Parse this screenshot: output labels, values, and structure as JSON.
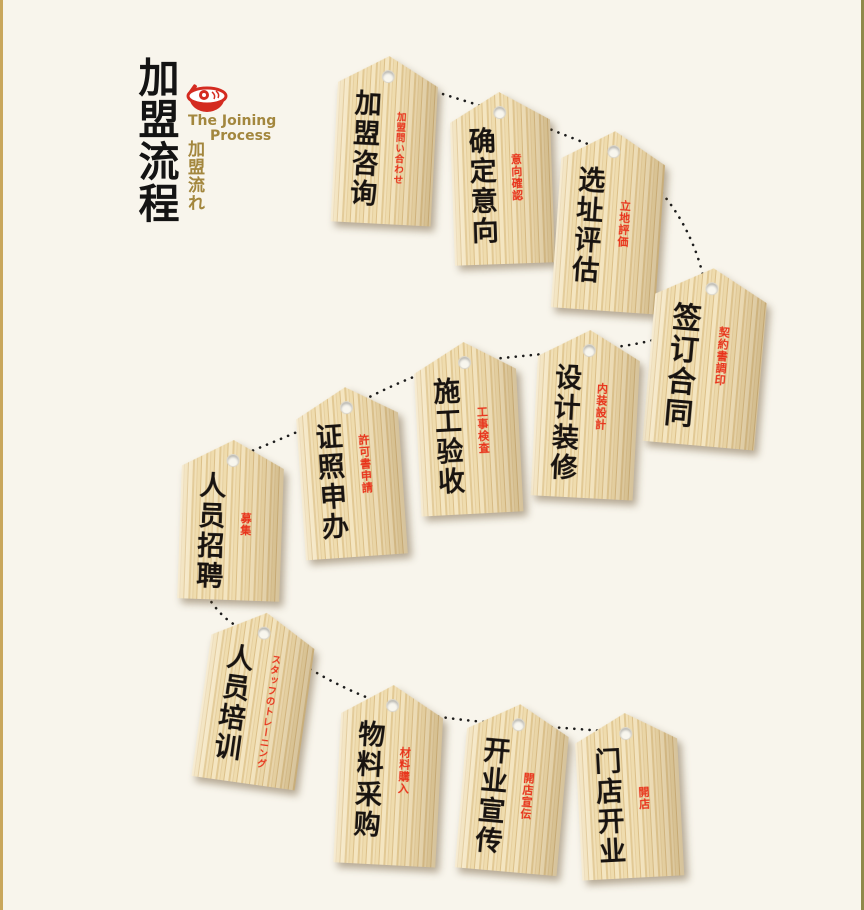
{
  "page": {
    "background": "#f8f5ec",
    "left_border_color": "#c9a75c",
    "right_border_color": "#8e894a"
  },
  "header": {
    "title": "加盟流程",
    "subtitle_en_line1": "The Joining",
    "subtitle_en_line2": "Process",
    "subtitle_jp": "加盟流れ",
    "icon": "ramen-bowl-icon",
    "title_color": "#141414",
    "accent_color": "#a3873e",
    "icon_color": "#d42b20"
  },
  "flow": {
    "connector": {
      "style": "dotted",
      "color": "#1c1c1c"
    },
    "tag": {
      "wood_light": "#f2e2ba",
      "wood_dark": "#ddc18b",
      "text_color": "#181310",
      "annotation_color": "#e8321a"
    },
    "steps": [
      {
        "order": 1,
        "label_cn": "加盟咨询",
        "label_jp": "加盟問い合わせ"
      },
      {
        "order": 2,
        "label_cn": "确定意向",
        "label_jp": "意向確認"
      },
      {
        "order": 3,
        "label_cn": "选址评估",
        "label_jp": "立地評価"
      },
      {
        "order": 4,
        "label_cn": "签订合同",
        "label_jp": "契約書調印"
      },
      {
        "order": 5,
        "label_cn": "设计装修",
        "label_jp": "内装設計"
      },
      {
        "order": 6,
        "label_cn": "施工验收",
        "label_jp": "工事検査"
      },
      {
        "order": 7,
        "label_cn": "证照申办",
        "label_jp": "許可書申請"
      },
      {
        "order": 8,
        "label_cn": "人员招聘",
        "label_jp": "募集"
      },
      {
        "order": 9,
        "label_cn": "人员培训",
        "label_jp": "スタッフのトレーニング"
      },
      {
        "order": 10,
        "label_cn": "物料采购",
        "label_jp": "材料購入"
      },
      {
        "order": 11,
        "label_cn": "开业宣传",
        "label_jp": "開店宣伝"
      },
      {
        "order": 12,
        "label_cn": "门店开业",
        "label_jp": "開店"
      }
    ]
  }
}
